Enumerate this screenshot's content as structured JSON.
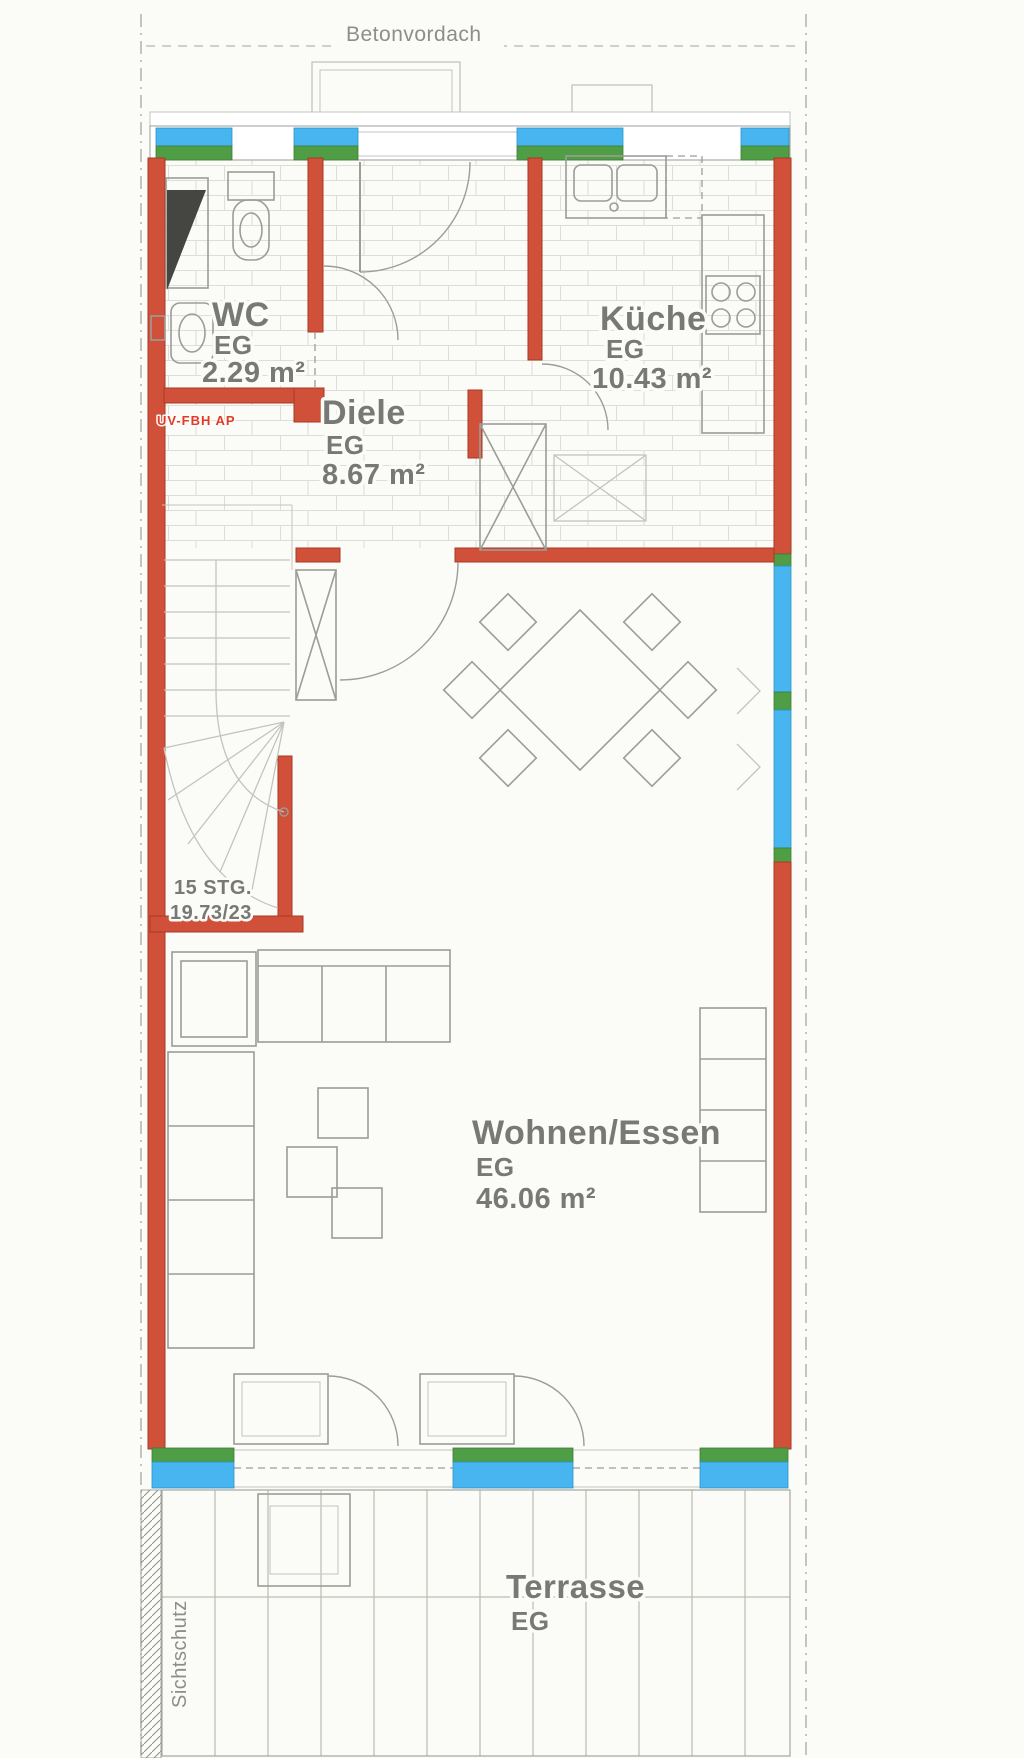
{
  "labels": {
    "canopy": "Betonvordach",
    "privacy_screen": "Sichtschutz",
    "heating_note": "UV-FBH AP",
    "stairs": {
      "line1": "15 STG.",
      "line2": "19.73/23"
    }
  },
  "rooms": {
    "wc": {
      "name": "WC",
      "level": "EG",
      "area": "2.29 m²"
    },
    "diele": {
      "name": "Diele",
      "level": "EG",
      "area": "8.67 m²"
    },
    "kueche": {
      "name": "Küche",
      "level": "EG",
      "area": "10.43 m²"
    },
    "wohnen_essen": {
      "name": "Wohnen/Essen",
      "level": "EG",
      "area": "46.06 m²"
    },
    "terrasse": {
      "name": "Terrasse",
      "level": "EG"
    }
  },
  "colors": {
    "wall_red": "#d0503a",
    "window_blue": "#47b5ef",
    "sill_green": "#4f9d45",
    "note_red": "#e23a2a",
    "line_gray": "#9c9c98",
    "tile_gray": "#d8d8d4",
    "text_gray": "#787876",
    "paper": "#fbfbf8"
  }
}
